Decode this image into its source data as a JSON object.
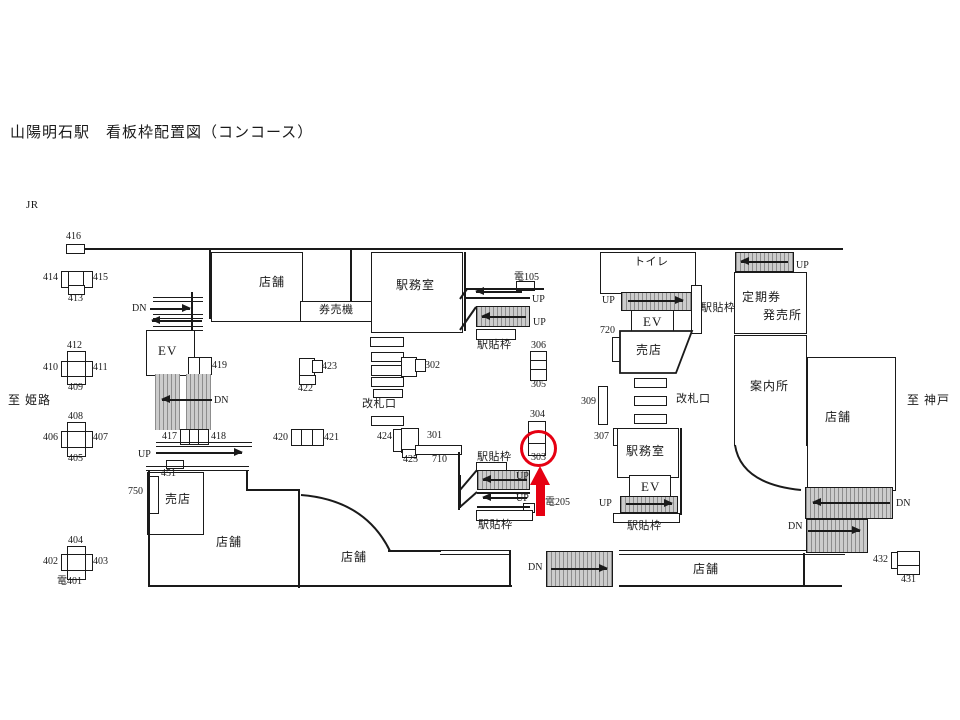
{
  "title": "山陽明石駅　看板枠配置図（コンコース）",
  "railway": "JR",
  "directions": {
    "west": "至 姫路",
    "east": "至 神戸"
  },
  "rooms": {
    "shop": "店舗",
    "station_office": "駅務室",
    "ticket_machines": "券売機",
    "toilet": "トイレ",
    "elevator": "EV",
    "kiosk": "売店",
    "commuter_pass_1": "定期券",
    "commuter_pass_2": "発売所",
    "information": "案内所",
    "ticket_gate": "改札口",
    "poster_frame": "駅貼枠"
  },
  "stairs": {
    "up": "UP",
    "down": "DN"
  },
  "frames": {
    "f301": "301",
    "f302": "302",
    "f303": "303",
    "f304": "304",
    "f305": "305",
    "f306": "306",
    "f307": "307",
    "f309": "309",
    "f401": "電401",
    "f402": "402",
    "f403": "403",
    "f404": "404",
    "f405": "405",
    "f406": "406",
    "f407": "407",
    "f408": "408",
    "f409": "409",
    "f410": "410",
    "f411": "411",
    "f412": "412",
    "f413": "413",
    "f414": "414",
    "f415": "415",
    "f416": "416",
    "f417": "417",
    "f418": "418",
    "f419": "419",
    "f420": "420",
    "f421": "421",
    "f422": "422",
    "f423": "423",
    "f424": "424",
    "f425": "425",
    "f431": "431",
    "f432": "432",
    "f451": "451",
    "f710": "710",
    "f720": "720",
    "f750": "750",
    "f105": "電105",
    "f205": "電205"
  },
  "highlight": {
    "circled_frame": "303",
    "color": "#e60012"
  }
}
